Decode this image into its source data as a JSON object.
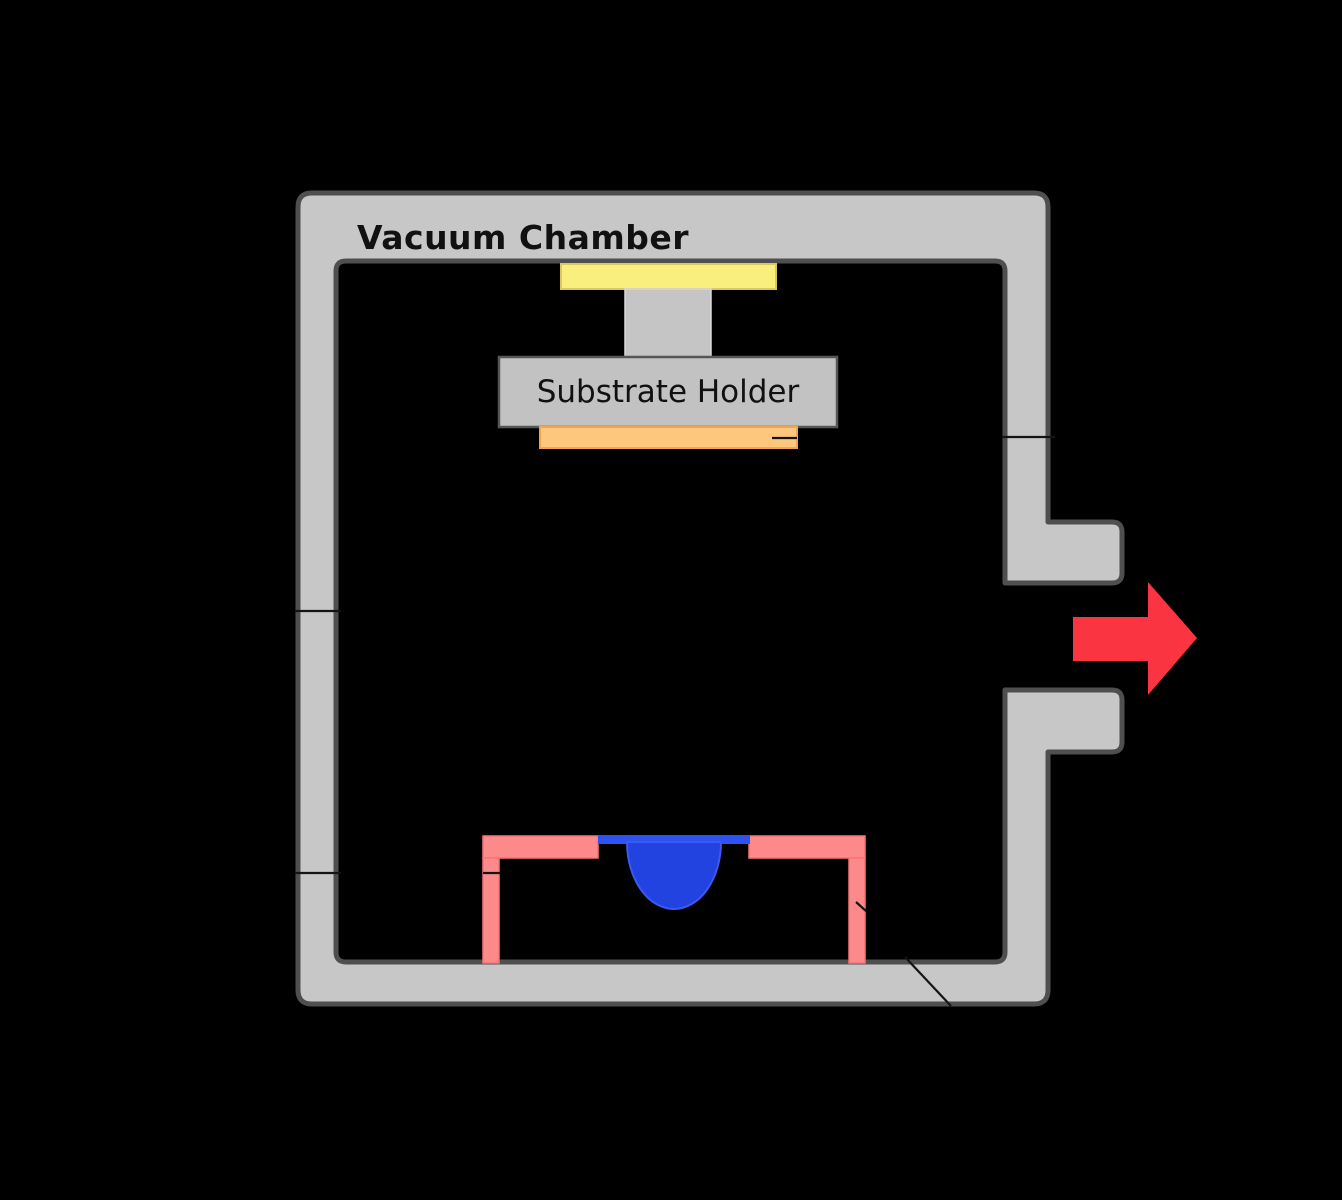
{
  "labels": {
    "vacuum_chamber": "Vacuum Chamber",
    "substrate_holder": "Substrate Holder"
  },
  "colors": {
    "background": "#000000",
    "wall_fill": "#c7c7c7",
    "wall_stroke": "#4f4f4f",
    "heater_plate_yellow": "#f9ef7f",
    "heater_plate_yellow_stroke": "#dcc95a",
    "substrate_orange": "#fdc87d",
    "substrate_orange_stroke": "#f0a64e",
    "holder_fill": "#c2c2c2",
    "holder_stroke": "#565656",
    "stem_fill": "#c5c5c5",
    "stem_stroke": "#d9d9d9",
    "source_boat_pink": "#fc8a8a",
    "source_boat_pink_stroke": "#f97474",
    "melt_blue": "#2243e0",
    "melt_blue_stroke": "#3a5af2",
    "melt_bar_blue": "#2d52f2",
    "arrow_red": "#fa3440",
    "leader_black": "#141414",
    "text": "#111111"
  }
}
